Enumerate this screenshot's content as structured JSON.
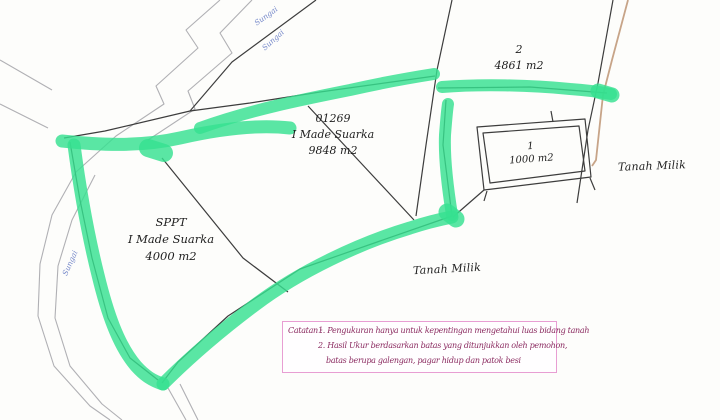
{
  "colors": {
    "paper": "#fdfdfb",
    "highlight": "#36e090",
    "ink": "#1f1f1f",
    "boundary": "#3d3d3d",
    "river": "#b0b0b4",
    "tan": "#c7a488",
    "note_border": "#e89ed3",
    "note_text": "#8c2d62",
    "river_label": "#7487c9"
  },
  "map": {
    "river_labels": [
      {
        "text": "Sungai"
      },
      {
        "text": "Sungai"
      },
      {
        "text": "Sungai"
      }
    ],
    "parcels": [
      {
        "number": "2",
        "area": "4861 m2"
      },
      {
        "number": "01269",
        "owner": "I Made Suarka",
        "area": "9848 m2"
      },
      {
        "number": "1",
        "area": "1000 m2"
      },
      {
        "number": "SPPT",
        "owner": "I Made Suarka",
        "area": "4000 m2"
      }
    ],
    "adjacent_labels": [
      {
        "text": "Tanah Milik"
      },
      {
        "text": "Tanah Milik"
      }
    ]
  },
  "notes": {
    "label": "Catatan :",
    "items": [
      "1. Pengukuran hanya untuk kepentingan mengetahui luas bidang tanah",
      "2. Hasil Ukur berdasarkan batas yang ditunjukkan oleh pemohon,",
      "batas berupa galengan, pagar hidup dan patok besi"
    ]
  }
}
